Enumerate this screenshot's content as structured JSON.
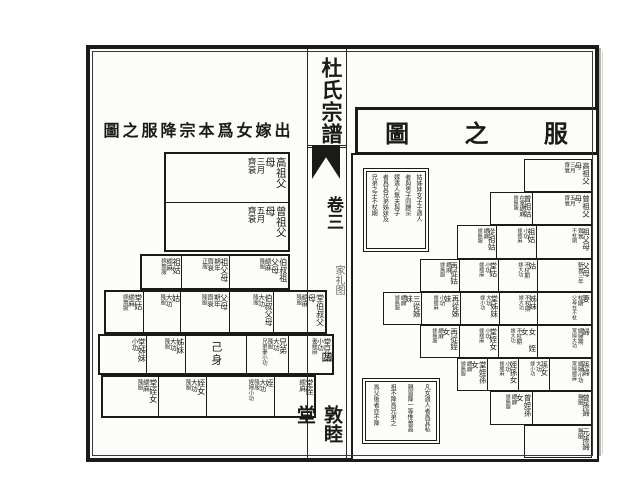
{
  "colors": {
    "ink": "#1c1a18",
    "paper": "#fcfcfa"
  },
  "spine": {
    "book_title": "杜氏宗譜",
    "volume": "卷三",
    "section": "家礼图",
    "page_number": "四",
    "hall": "敦睦堂"
  },
  "left_chart": {
    "title": "圖之服降宗本爲女嫁出",
    "rows": [
      {
        "cells": [
          {
            "name": "高祖父母",
            "grade": "齊衰",
            "duration": "三月"
          }
        ]
      },
      {
        "cells": [
          {
            "name": "曾祖父母",
            "grade": "齊衰",
            "duration": "五月"
          }
        ]
      },
      {
        "cells": [
          {
            "name": "祖姑",
            "grade": "緦麻",
            "note": "嫁無服"
          },
          {
            "name": "祖父母",
            "duration": "期年",
            "grade": "齊衰",
            "note": "正服"
          },
          {
            "name": "伯叔祖父母",
            "grade": "緦麻",
            "note": "降服"
          }
        ]
      },
      {
        "cells": [
          {
            "name": "堂姑",
            "grade": "緦麻",
            "note": "嫁無服"
          },
          {
            "name": "姑",
            "grade": "大功",
            "note": "降服"
          },
          {
            "name": "父母",
            "duration": "期年",
            "grade": "齊衰",
            "note": "降服"
          },
          {
            "name": "伯叔父母",
            "grade": "大功",
            "note": "降服"
          },
          {
            "name": "堂伯叔父母",
            "grade": "緦麻",
            "note": "降服"
          }
        ]
      },
      {
        "cells": [
          {
            "name": "堂姊妹",
            "grade": "小功"
          },
          {
            "name": "姊妹",
            "grade": "大功",
            "note": "降服"
          },
          {
            "name": "己身"
          },
          {
            "name": "兄弟",
            "grade": "大功",
            "note": "降服",
            "extra": "兄弟妻小功"
          },
          {
            "name": "堂兄弟",
            "grade": "小功",
            "extra": "妻緦麻"
          }
        ]
      },
      {
        "cells": [
          {
            "name": "堂姪女",
            "grade": "緦麻",
            "note": "降服"
          },
          {
            "name": "姪女",
            "grade": "大功",
            "note": "降服"
          },
          {
            "name": "姪",
            "grade": "大功",
            "note": "降服",
            "extra": "姪婦小功"
          },
          {
            "name": "堂姪",
            "grade": "緦麻"
          }
        ]
      }
    ]
  },
  "right_chart": {
    "title": "服之圖",
    "title_chars": [
      "圖",
      "之",
      "服"
    ],
    "note_top_columns": [
      "姑姊妹女子子適人",
      "者與男子同歸宗",
      "嫁遣人無夫與子",
      "者爲其兄弟姊妹及",
      "兄弟之子不杖期"
    ],
    "note_bottom_columns": [
      "凡女適人者爲其私",
      "親皆降一等惟曾高",
      "祖不降爲兄弟之",
      "爲父後者亦不降"
    ],
    "rows": [
      {
        "cells": [
          {
            "name": "高祖父母",
            "grade": "齊衰",
            "duration": "三月"
          }
        ]
      },
      {
        "cells": [
          {
            "name": "曾祖姑",
            "grade": "在室緦麻",
            "note": "嫁無服"
          },
          {
            "name": "曾祖父母",
            "grade": "齊衰",
            "duration": "五月"
          }
        ]
      },
      {
        "cells": [
          {
            "name": "從祖姑",
            "grade": "緦麻",
            "note": "嫁無服"
          },
          {
            "name": "祖姑",
            "grade": "小功",
            "note": "嫁緦麻"
          },
          {
            "name": "祖父母",
            "grade": "齊衰",
            "note": "不杖期"
          }
        ]
      },
      {
        "cells": [
          {
            "name": "再從姑",
            "grade": "緦麻",
            "note": "嫁無服"
          },
          {
            "name": "堂姑",
            "grade": "小功",
            "note": "嫁緦麻"
          },
          {
            "name": "姑",
            "grade": "不杖期",
            "note": "嫁大功"
          },
          {
            "name": "父母",
            "grade": "斬衰三年"
          }
        ]
      },
      {
        "cells": [
          {
            "name": "三從姊妹",
            "grade": "緦麻",
            "note": "嫁無服"
          },
          {
            "name": "再從姊妹",
            "grade": "小功",
            "note": "嫁緦麻"
          },
          {
            "name": "堂姊妹",
            "grade": "大功",
            "note": "嫁小功"
          },
          {
            "name": "姊妹",
            "grade": "不杖期",
            "note": "嫁大功"
          },
          {
            "name": "妻",
            "grade": "杖期",
            "note": "父母在不杖"
          }
        ]
      },
      {
        "cells": [
          {
            "name": "再從姪女",
            "grade": "緦麻",
            "note": "嫁無服"
          },
          {
            "name": "堂姪女",
            "grade": "小功",
            "note": "嫁緦麻"
          },
          {
            "name": "女 姪女",
            "grade": "不杖期",
            "note": "嫁大功"
          },
          {
            "name": "婦",
            "grade": "嫡婦期",
            "note": "眾婦大功"
          }
        ]
      },
      {
        "cells": [
          {
            "name": "堂姪孫女",
            "grade": "緦麻",
            "note": "嫁無服"
          },
          {
            "name": "姪孫女",
            "grade": "小功",
            "note": "嫁緦麻"
          },
          {
            "name": "孫女",
            "grade": "大功",
            "note": "嫁小功"
          },
          {
            "name": "孫婦",
            "grade": "嫡婦小功",
            "note": "眾婦緦麻"
          }
        ]
      },
      {
        "cells": [
          {
            "name": "曾姪孫女",
            "grade": "緦麻",
            "note": "嫁無服"
          },
          {
            "name": "曾孫婦",
            "grade": "無服"
          }
        ]
      },
      {
        "cells": [
          {
            "name": "元孫婦",
            "grade": "無服"
          }
        ]
      }
    ]
  }
}
